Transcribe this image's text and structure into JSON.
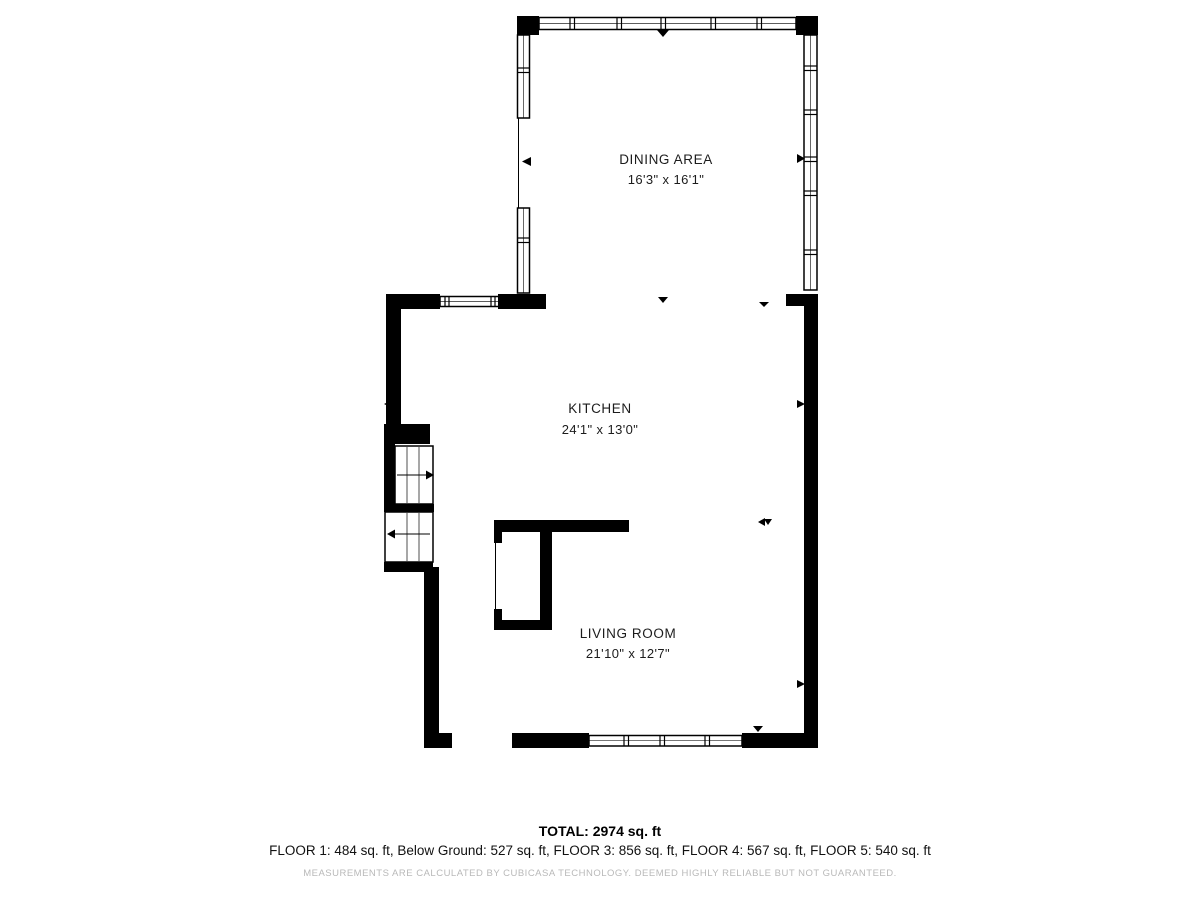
{
  "page": {
    "background": "#ffffff"
  },
  "plan": {
    "wall_color": "#000000",
    "label_color": "#1c1c1c",
    "rooms": [
      {
        "id": "dining-area",
        "name": "DINING AREA",
        "dimensions": "16'3\" x 16'1\""
      },
      {
        "id": "kitchen",
        "name": "KITCHEN",
        "dimensions": "24'1\" x 13'0\""
      },
      {
        "id": "living-room",
        "name": "LIVING ROOM",
        "dimensions": "21'10\" x 12'7\""
      }
    ]
  },
  "footer": {
    "total": "TOTAL: 2974 sq. ft",
    "floor_breakdown": "FLOOR 1: 484 sq. ft, Below Ground: 527 sq. ft, FLOOR 3: 856 sq. ft, FLOOR 4: 567 sq. ft, FLOOR 5: 540 sq. ft",
    "floors": [
      {
        "label": "FLOOR 1",
        "area": "484 sq. ft"
      },
      {
        "label": "Below Ground",
        "area": "527 sq. ft"
      },
      {
        "label": "FLOOR 3",
        "area": "856 sq. ft"
      },
      {
        "label": "FLOOR 4",
        "area": "567 sq. ft"
      },
      {
        "label": "FLOOR 5",
        "area": "540 sq. ft"
      },
      {
        "label": "TOTAL",
        "area": "2974 sq. ft"
      }
    ],
    "disclaimer": "MEASUREMENTS ARE CALCULATED BY CUBICASA TECHNOLOGY. DEEMED HIGHLY RELIABLE BUT NOT GUARANTEED.",
    "disclaimer_color": "#b9b9b9"
  }
}
